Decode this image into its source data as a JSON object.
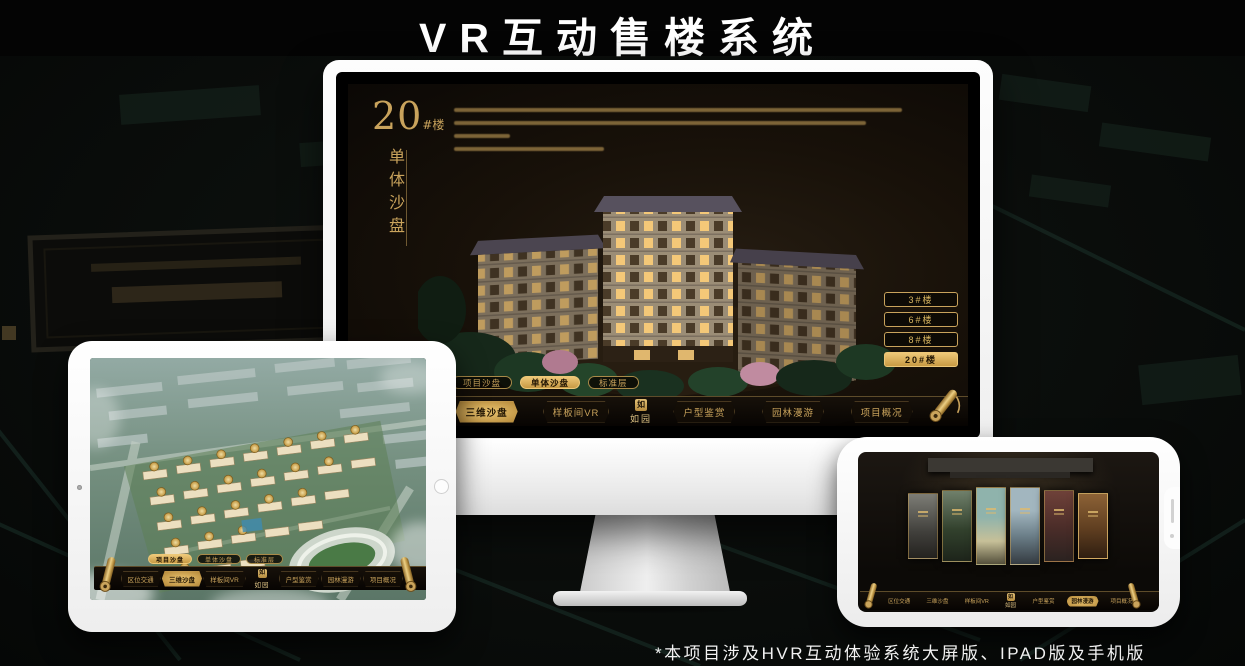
{
  "title": "VR互动售楼系统",
  "footer_note": "*本项目涉及HVR互动体验系统大屏版、IPAD版及手机版",
  "brand": {
    "logo_name": "如园",
    "seal_char": "如"
  },
  "colors": {
    "gold": "#c9a35c",
    "gold_bright": "#eec878",
    "screen_bg": "#181109",
    "nav_bg": "#0a0703"
  },
  "monitor": {
    "heading_number": "20",
    "heading_unit": "#楼",
    "heading_subtitle": "单体沙盘",
    "paragraph_line_widths": [
      448,
      412,
      56,
      150
    ],
    "floor_buttons": [
      {
        "label": "3#楼",
        "active": false
      },
      {
        "label": "6#楼",
        "active": false
      },
      {
        "label": "8#楼",
        "active": false
      },
      {
        "label": "20#楼",
        "active": true
      }
    ],
    "sub_tabs": [
      {
        "label": "项目沙盘",
        "active": false
      },
      {
        "label": "单体沙盘",
        "active": true
      },
      {
        "label": "标准层",
        "active": false
      }
    ],
    "nav_left": [
      {
        "label": "区位交通",
        "active": false
      },
      {
        "label": "三维沙盘",
        "active": true
      },
      {
        "label": "样板间VR",
        "active": false
      }
    ],
    "nav_right": [
      {
        "label": "户型鉴赏",
        "active": false
      },
      {
        "label": "园林漫游",
        "active": false
      },
      {
        "label": "项目概况",
        "active": false
      }
    ]
  },
  "tablet": {
    "sub_tabs": [
      {
        "label": "项目沙盘",
        "active": true
      },
      {
        "label": "单体沙盘",
        "active": false
      },
      {
        "label": "标准层",
        "active": false
      }
    ],
    "nav_left": [
      {
        "label": "区位交通",
        "active": false
      },
      {
        "label": "三维沙盘",
        "active": true
      },
      {
        "label": "样板间VR",
        "active": false
      }
    ],
    "nav_right": [
      {
        "label": "户型鉴赏",
        "active": false
      },
      {
        "label": "园林漫游",
        "active": false
      },
      {
        "label": "项目概况",
        "active": false
      }
    ]
  },
  "phone": {
    "nav_left": [
      {
        "label": "区位交通",
        "active": false
      },
      {
        "label": "三维沙盘",
        "active": false
      },
      {
        "label": "样板间VR",
        "active": false
      }
    ],
    "nav_right": [
      {
        "label": "户型鉴赏",
        "active": false
      },
      {
        "label": "园林漫游",
        "active": true
      },
      {
        "label": "项目概况",
        "active": false
      }
    ]
  }
}
